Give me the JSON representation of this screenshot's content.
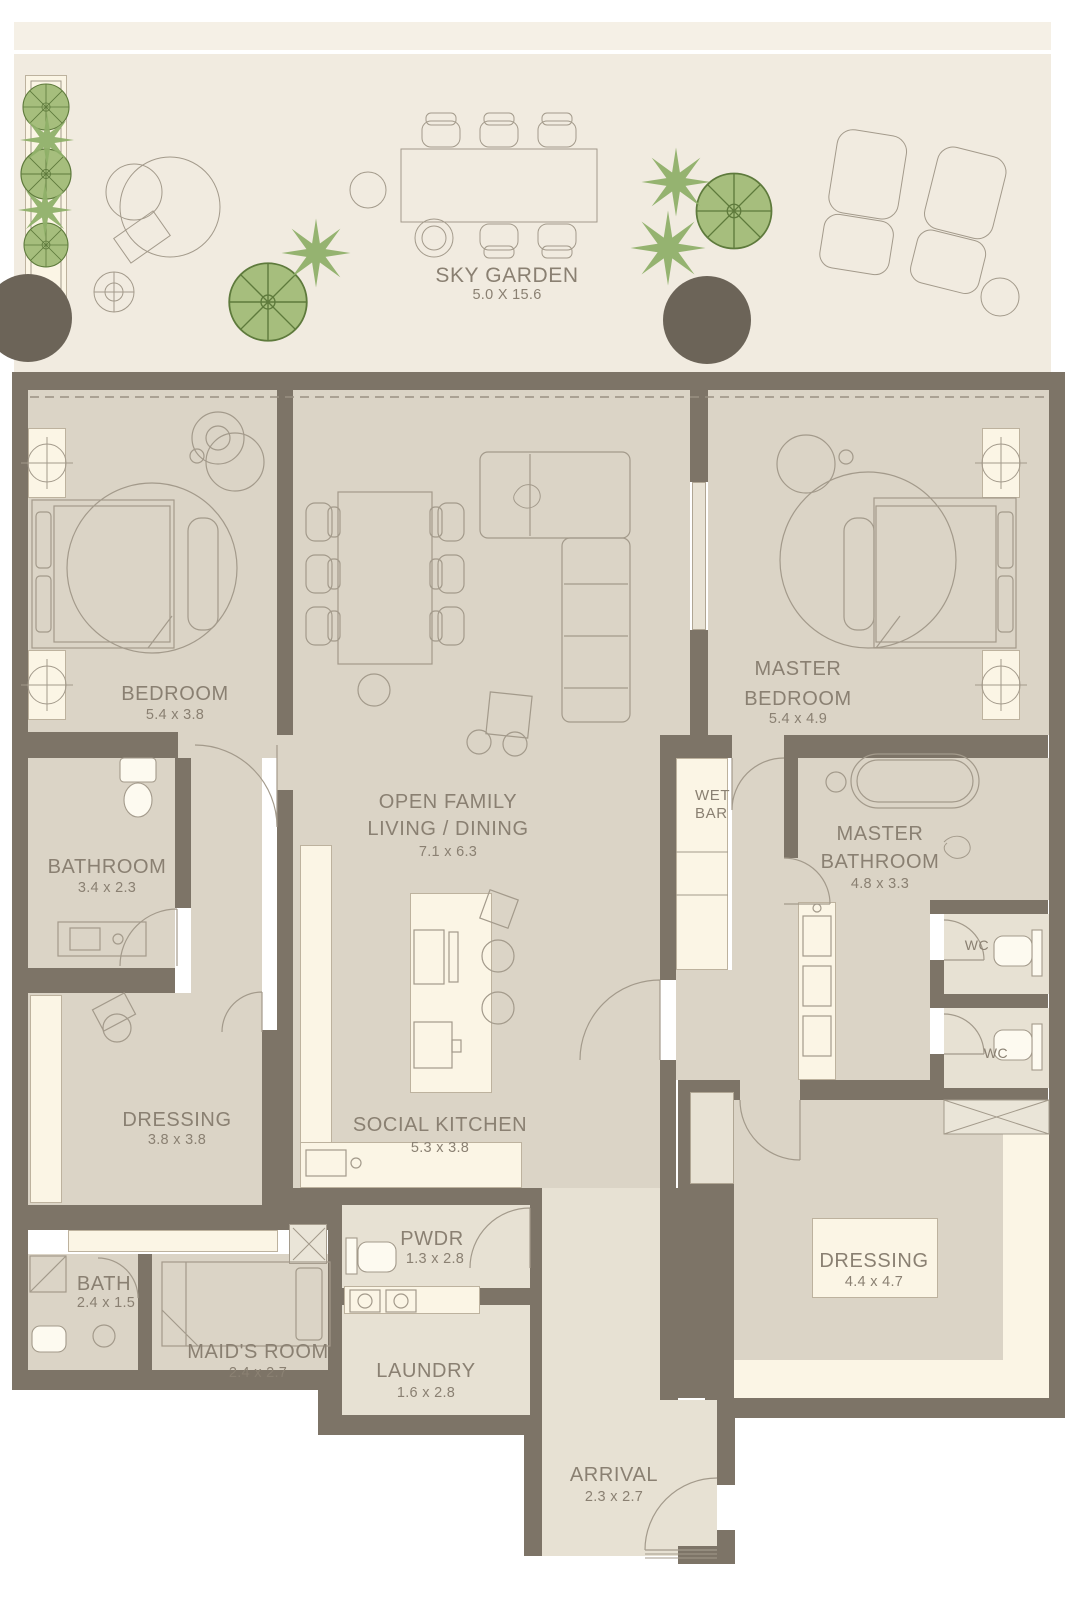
{
  "plan": {
    "title": "Apartment Floor Plan",
    "garden": {
      "name": "SKY GARDEN",
      "dims": "5.0 X 15.6"
    },
    "rooms": {
      "bedroom": {
        "name": "BEDROOM",
        "dims": "5.4 x 3.8"
      },
      "living": {
        "line1": "OPEN FAMILY",
        "line2": "LIVING / DINING",
        "dims": "7.1 x 6.3"
      },
      "master_bedroom": {
        "line1": "MASTER",
        "line2": "BEDROOM",
        "dims": "5.4 x 4.9"
      },
      "bathroom": {
        "name": "BATHROOM",
        "dims": "3.4 x 2.3"
      },
      "wet_bar": {
        "line1": "WET",
        "line2": "BAR"
      },
      "master_bathroom": {
        "line1": "MASTER",
        "line2": "BATHROOM",
        "dims": "4.8 x 3.3"
      },
      "wc1": {
        "name": "WC"
      },
      "wc2": {
        "name": "WC"
      },
      "dressing1": {
        "name": "DRESSING",
        "dims": "3.8 x 3.8"
      },
      "social_kitchen": {
        "name": "SOCIAL KITCHEN",
        "dims": "5.3 x 3.8"
      },
      "pwdr": {
        "name": "PWDR",
        "dims": "1.3 x 2.8"
      },
      "bath": {
        "name": "BATH",
        "dims": "2.4 x 1.5"
      },
      "maids_room": {
        "name": "MAID'S ROOM",
        "dims": "2.4 x 2.7"
      },
      "laundry": {
        "name": "LAUNDRY",
        "dims": "1.6 x 2.8"
      },
      "dressing2": {
        "name": "DRESSING",
        "dims": "4.4 x 4.7"
      },
      "arrival": {
        "name": "ARRIVAL",
        "dims": "2.3 x 2.7"
      }
    },
    "colors": {
      "wall": "#7d7467",
      "floor": "#dbd4c6",
      "floor_light": "#e7e1d3",
      "cream": "#fbf5e5",
      "garden": "#f1ebe0",
      "garden_strip": "#f5f0e6",
      "line": "#a39a8b",
      "text": "#8a8072",
      "green": "#a6be7d",
      "green_2": "#8fb069",
      "green_dark": "#5e7a3c",
      "dark_circle": "#6c6458",
      "fixture": "#fdfaf0"
    }
  }
}
